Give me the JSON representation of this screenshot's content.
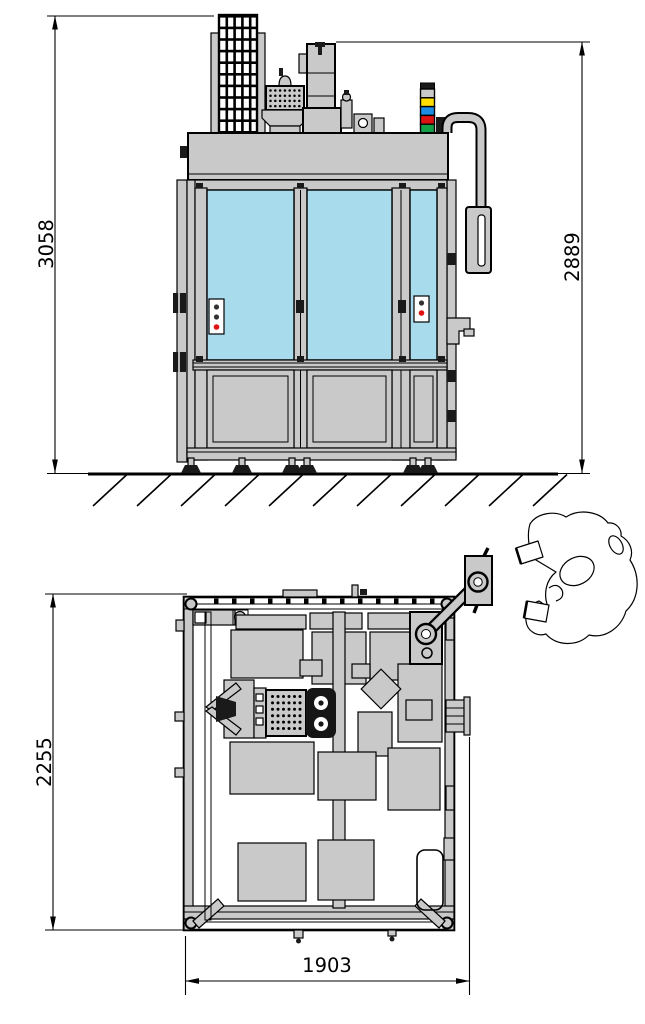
{
  "drawing": {
    "kind": "machine-dimension-drawing",
    "front_view": {
      "name": "front-elevation",
      "dim_overall_height": "3058",
      "dim_enclosure_height": "2889",
      "signal_tower_colors": [
        "#c9c9c9",
        "#ffdf00",
        "#1d8de4",
        "#df1212",
        "#13a047"
      ]
    },
    "plan_view": {
      "name": "top-view",
      "dim_depth": "2255",
      "dim_width": "1903"
    },
    "colors": {
      "panel_gray": "#c9c9c9",
      "glass_blue": "#a8dcec",
      "line": "#000000",
      "dark_fill": "#1a1a1a",
      "background": "#ffffff"
    }
  }
}
